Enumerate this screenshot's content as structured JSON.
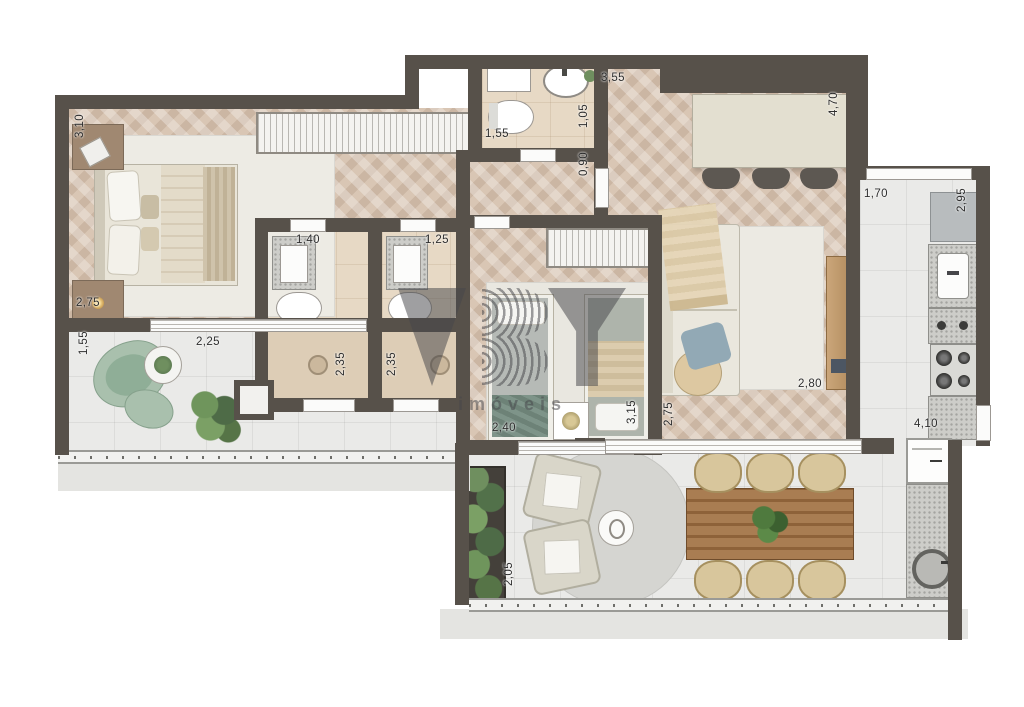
{
  "title": "apartment-floor-plan",
  "watermark": {
    "brand": "VBY",
    "subtitle": "imóveis",
    "color": "#46464a"
  },
  "palette": {
    "wall": "#57514a",
    "wood_floor": "#d9c6b4",
    "tile_floor": "#eaeae8",
    "bath_floor": "#e7d9c5",
    "ledge": "#e4e4e1",
    "dining_wood": "#96693f",
    "sage_green": "#a9c0ad",
    "plant_green": "#5e7d54"
  },
  "dimensions": [
    {
      "text": "3,10",
      "orientation": "vertical",
      "area": "master-bedroom"
    },
    {
      "text": "2,75",
      "orientation": "horizontal",
      "area": "master-bedroom"
    },
    {
      "text": "1,55",
      "orientation": "vertical",
      "area": "balcony"
    },
    {
      "text": "2,25",
      "orientation": "horizontal",
      "area": "balcony"
    },
    {
      "text": "1,40",
      "orientation": "horizontal",
      "area": "bathroom-1"
    },
    {
      "text": "2,35",
      "orientation": "vertical",
      "area": "bathroom-1"
    },
    {
      "text": "1,25",
      "orientation": "horizontal",
      "area": "bathroom-2"
    },
    {
      "text": "2,35",
      "orientation": "vertical",
      "area": "bathroom-2"
    },
    {
      "text": "1,55",
      "orientation": "horizontal",
      "area": "bathroom-3"
    },
    {
      "text": "1,05",
      "orientation": "vertical",
      "area": "bathroom-3"
    },
    {
      "text": "0,90",
      "orientation": "vertical",
      "area": "corridor"
    },
    {
      "text": "3,55",
      "orientation": "horizontal",
      "area": "hall"
    },
    {
      "text": "4,70",
      "orientation": "vertical",
      "area": "living-island"
    },
    {
      "text": "1,70",
      "orientation": "horizontal",
      "area": "kitchen"
    },
    {
      "text": "2,95",
      "orientation": "vertical",
      "area": "kitchen"
    },
    {
      "text": "2,80",
      "orientation": "horizontal",
      "area": "living"
    },
    {
      "text": "4,10",
      "orientation": "horizontal",
      "area": "service"
    },
    {
      "text": "2,40",
      "orientation": "horizontal",
      "area": "bedroom-2"
    },
    {
      "text": "3,15",
      "orientation": "vertical",
      "area": "bedroom-2"
    },
    {
      "text": "2,75",
      "orientation": "vertical",
      "area": "living"
    },
    {
      "text": "2,05",
      "orientation": "vertical",
      "area": "terrace"
    }
  ]
}
